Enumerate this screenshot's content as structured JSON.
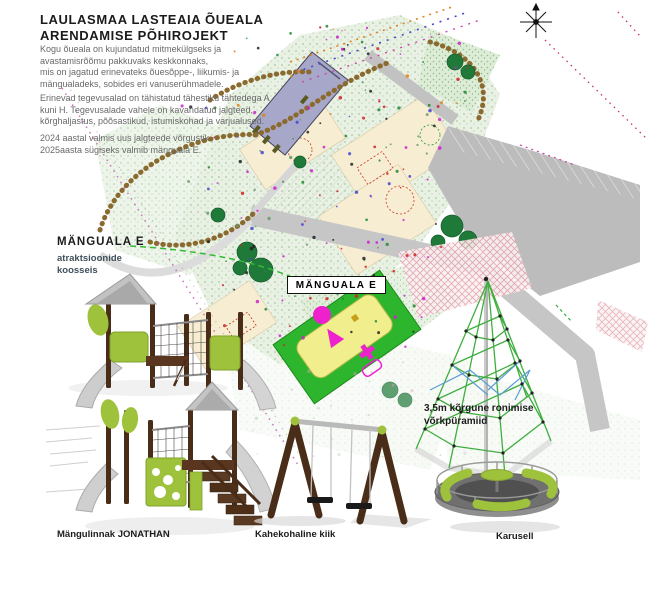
{
  "header": {
    "title_line1": "LAULASMAA LASTEAIA ÕUEALA",
    "title_line2": "ARENDAMISE PÕHIROJEKT",
    "para1": "Kogu õueala on kujundatud mitmekülgseks ja\navastamisrõõmu pakkuvaks keskkonnaks,\nmis on jagatud erinevateks õuesõppe-, liikumis- ja\nmängualadeks, sobides eri vanuserühmadele.",
    "para2": "Erinevad tegevusalad on tähistatud tähestiku tähtedega A\nkuni H. Tegevusalade vahele on kavandatud jalgteed,\nkõrghaljastus, põõsastikud, istumiskohad ja varjualused.",
    "para3": "2024 aastal valmis uus jalgteede võrgustik.\n2025aasta sügiseks valmib mänguala E."
  },
  "left_note": {
    "title": "MÄNGUALA E",
    "subtitle": "atraktsioonide\nkoosseis"
  },
  "map": {
    "area_label": "MÄNGUALA E"
  },
  "pyramid_note": "3,5m kõrgune ronimise\nvõrkpüramiid",
  "equipment": [
    {
      "label": "Mängulinnak JONATHAN"
    },
    {
      "label": "Kahekohaline kiik"
    },
    {
      "label": "Karusell"
    }
  ],
  "colors": {
    "zone_green": "#2eb52e",
    "equipment_lime": "#9fc23c",
    "magenta": "#ee22cc",
    "wood_brown": "#4a2d18",
    "building_blue": "#a7a7c9"
  }
}
